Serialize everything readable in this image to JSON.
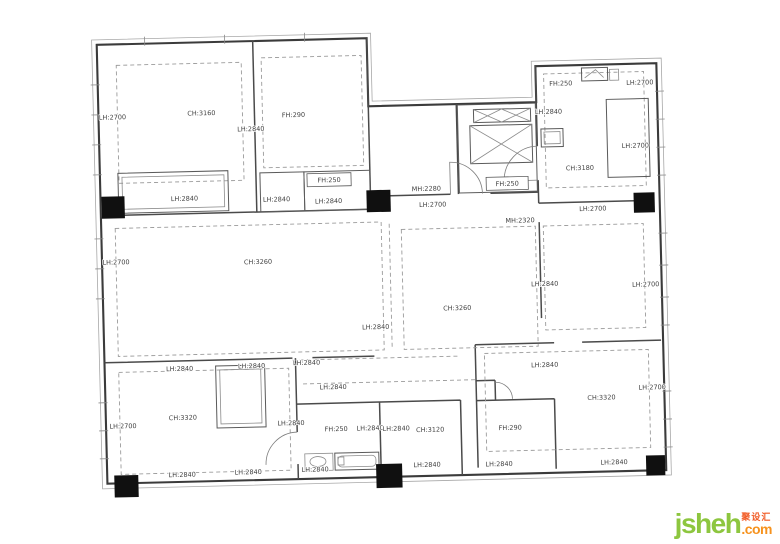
{
  "watermark": {
    "brand": "jsheh",
    "tld": ".com",
    "cjk": "聚设汇",
    "brand_color": "#8dc63f",
    "tld_color": "#f6921e",
    "cjk_color": "#f15a24"
  },
  "plan": {
    "description": "apartment survey floor plan with ceiling (CH), lintel (LH), door (MH) and beam (FH) height annotations in mm",
    "line_color": "#3b3b3b",
    "rotation_deg": -1.4,
    "labels": [
      {
        "text": "LH:2700",
        "x": 116,
        "y": 113
      },
      {
        "text": "CH:3160",
        "x": 205,
        "y": 111
      },
      {
        "text": "LH:2840",
        "x": 254,
        "y": 128
      },
      {
        "text": "FH:290",
        "x": 297,
        "y": 115
      },
      {
        "text": "LH:2840",
        "x": 186,
        "y": 196
      },
      {
        "text": "LH:2840",
        "x": 278,
        "y": 199
      },
      {
        "text": "LH:2840",
        "x": 330,
        "y": 202
      },
      {
        "text": "MH:2280",
        "x": 428,
        "y": 192
      },
      {
        "text": "LH:2700",
        "x": 434,
        "y": 208
      },
      {
        "text": "LH:2840",
        "x": 552,
        "y": 118
      },
      {
        "text": "FH:250",
        "x": 565,
        "y": 90
      },
      {
        "text": "LH:2700",
        "x": 644,
        "y": 91
      },
      {
        "text": "CH:3180",
        "x": 582,
        "y": 175
      },
      {
        "text": "LH:2700",
        "x": 638,
        "y": 154
      },
      {
        "text": "MH:2320",
        "x": 521,
        "y": 226
      },
      {
        "text": "LH:2700",
        "x": 594,
        "y": 216
      },
      {
        "text": "LH:2700",
        "x": 116,
        "y": 258
      },
      {
        "text": "CH:3260",
        "x": 258,
        "y": 261
      },
      {
        "text": "LH:2840",
        "x": 374,
        "y": 329
      },
      {
        "text": "CH:3260",
        "x": 456,
        "y": 312
      },
      {
        "text": "LH:2840",
        "x": 544,
        "y": 290
      },
      {
        "text": "LH:2700",
        "x": 645,
        "y": 293
      },
      {
        "text": "LH:2840",
        "x": 177,
        "y": 366
      },
      {
        "text": "LH:2840",
        "x": 249,
        "y": 365
      },
      {
        "text": "LH:2840",
        "x": 304,
        "y": 363
      },
      {
        "text": "LH:2840",
        "x": 330,
        "y": 388
      },
      {
        "text": "LH:2700",
        "x": 119,
        "y": 422
      },
      {
        "text": "CH:3320",
        "x": 179,
        "y": 415
      },
      {
        "text": "LH:2840",
        "x": 287,
        "y": 423
      },
      {
        "text": "FH:250",
        "x": 332,
        "y": 430
      },
      {
        "text": "LH:2840",
        "x": 366,
        "y": 430
      },
      {
        "text": "LH:2840",
        "x": 392,
        "y": 431
      },
      {
        "text": "CH:3120",
        "x": 426,
        "y": 433
      },
      {
        "text": "LH:2840",
        "x": 177,
        "y": 472
      },
      {
        "text": "LH:2840",
        "x": 243,
        "y": 471
      },
      {
        "text": "LH:2840",
        "x": 310,
        "y": 470
      },
      {
        "text": "LH:2840",
        "x": 422,
        "y": 468
      },
      {
        "text": "FH:290",
        "x": 506,
        "y": 433
      },
      {
        "text": "LH:2840",
        "x": 494,
        "y": 469
      },
      {
        "text": "LH:2840",
        "x": 542,
        "y": 371
      },
      {
        "text": "CH:3320",
        "x": 598,
        "y": 405
      },
      {
        "text": "LH:2700",
        "x": 649,
        "y": 396
      },
      {
        "text": "LH:2840",
        "x": 609,
        "y": 470
      }
    ],
    "boxed_labels": [
      {
        "text": "FH:250",
        "x": 331,
        "y": 181,
        "bx": 309,
        "by": 172,
        "bw": 44,
        "bh": 13
      },
      {
        "text": "FH:250",
        "x": 509,
        "y": 189,
        "bx": 488,
        "by": 180,
        "bw": 42,
        "bh": 13
      }
    ],
    "columns": [
      {
        "x": 103,
        "y": 190,
        "w": 23,
        "h": 22
      },
      {
        "x": 368,
        "y": 190,
        "w": 24,
        "h": 22
      },
      {
        "x": 635,
        "y": 199,
        "w": 21,
        "h": 20
      },
      {
        "x": 109,
        "y": 469,
        "w": 24,
        "h": 22
      },
      {
        "x": 371,
        "y": 464,
        "w": 26,
        "h": 24
      },
      {
        "x": 641,
        "y": 462,
        "w": 19,
        "h": 20
      }
    ],
    "fixtures": [
      "stair-shaft",
      "elevator-shaft",
      "entry-door",
      "wardrobes",
      "window-bays",
      "bathtub",
      "vanity"
    ]
  }
}
